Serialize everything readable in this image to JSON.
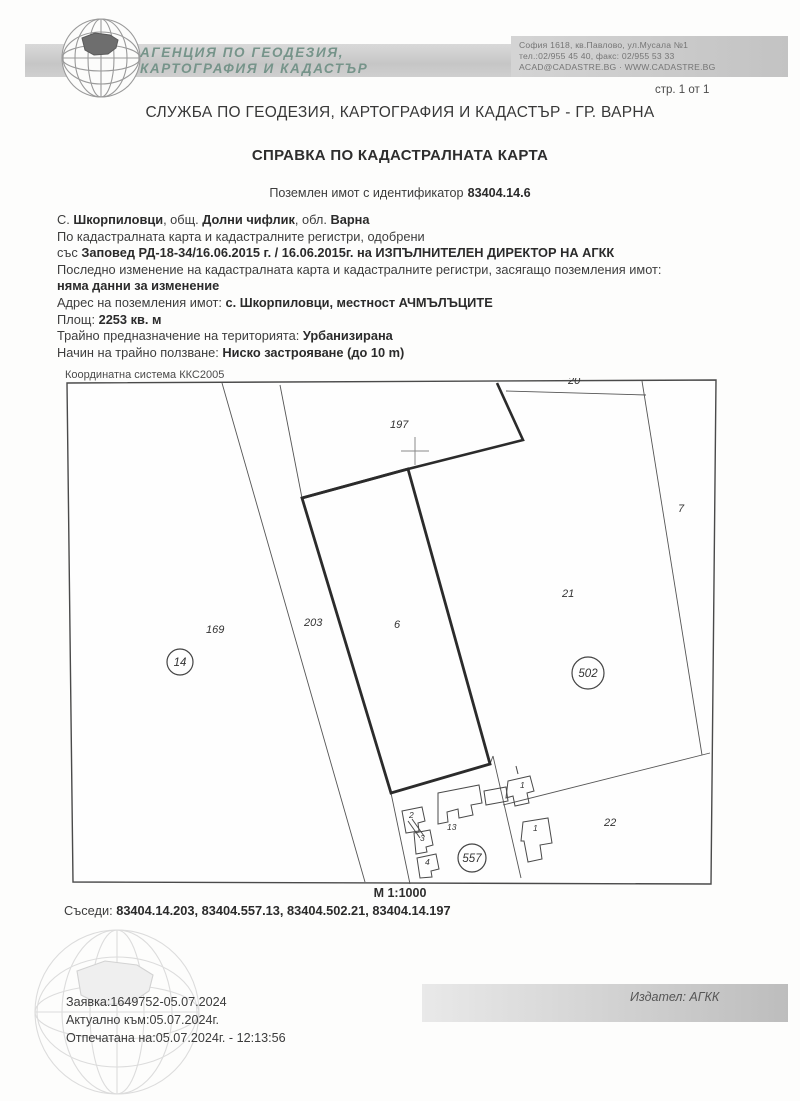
{
  "header": {
    "agency_name_line1": "АГЕНЦИЯ ПО ГЕОДЕЗИЯ,",
    "agency_name_line2": "КАРТОГРАФИЯ И КАДАСТЪР",
    "address_line1": "София 1618, кв.Павлово, ул.Мусала №1",
    "address_line2": "тел.:02/955 45 40, факс: 02/955 53 33",
    "address_line3": "ACAD@CADASTRE.BG · WWW.CADASTRE.BG",
    "page_indicator": "стр. 1 от 1"
  },
  "titles": {
    "office": "СЛУЖБА ПО ГЕОДЕЗИЯ, КАРТОГРАФИЯ И КАДАСТЪР - ГР. ВАРНА",
    "document": "СПРАВКА ПО КАДАСТРАЛНАТА КАРТА",
    "property_label": "Поземлен имот с идентификатор",
    "property_id": "83404.14.6"
  },
  "property": {
    "location_prefix": "С. ",
    "settlement": "Шкорпиловци",
    "municipality_label": ", общ. ",
    "municipality": "Долни чифлик",
    "district_label": ", обл. ",
    "district": "Варна",
    "approved_line": "По кадастралната карта и кадастралните регистри, одобрени",
    "order_prefix": "със ",
    "order": "Заповед РД-18-34/16.06.2015 г. / 16.06.2015г. на ИЗПЪЛНИТЕЛЕН ДИРЕКТОР НА АГКК",
    "last_change_label": "Последно изменение на кадастралната карта и кадастралните регистри, засягащо поземления имот:",
    "last_change_value": "няма данни за изменение",
    "address_label": "Адрес на поземления имот: ",
    "address_value": "с. Шкорпиловци, местност АЧМЪЛЪЦИТЕ",
    "area_label": "Площ: ",
    "area_value": "2253 кв. м",
    "territory_label": "Трайно предназначение на територията: ",
    "territory_value": "Урбанизирана",
    "usage_label": "Начин на трайно ползване: ",
    "usage_value": "Ниско застрояване (до 10 m)"
  },
  "map": {
    "coordinate_system": "Координатна система ККС2005",
    "scale": "М 1:1000",
    "neighbors_label": "Съседи: ",
    "neighbors": "83404.14.203, 83404.557.13, 83404.502.21, 83404.14.197",
    "parcel_labels": {
      "p197": "197",
      "p20": "20",
      "p7": "7",
      "p21": "21",
      "p169": "169",
      "p203": "203",
      "p6": "6",
      "p22": "22",
      "c14": "14",
      "c502": "502",
      "c557": "557",
      "b1a": "1",
      "b1b": "1",
      "b2": "2",
      "b3": "3",
      "b4": "4",
      "b13": "13"
    }
  },
  "footer": {
    "request": "Заявка:1649752-05.07.2024",
    "valid_as_of": "Актуално към:05.07.2024г.",
    "printed_at": "Отпечатана на:05.07.2024г. - 12:13:56",
    "issuer": "Издател: АГКК"
  }
}
